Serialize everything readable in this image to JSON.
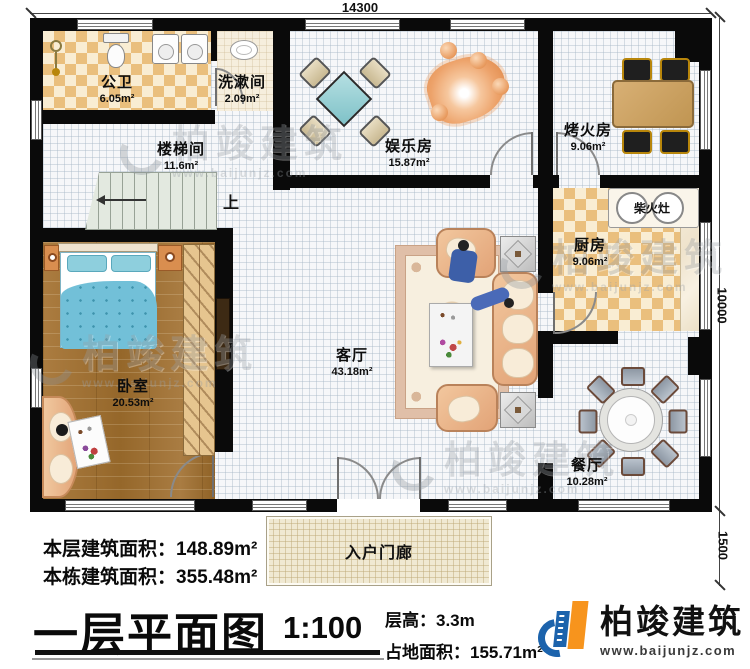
{
  "plan": {
    "dim_top": "14300",
    "dim_right": "10000",
    "dim_porch": "1500",
    "rooms": [
      {
        "name": "公卫",
        "area": "6.05m²"
      },
      {
        "name": "洗漱间",
        "area": "2.09m²"
      },
      {
        "name": "楼梯间",
        "area": "11.6m²"
      },
      {
        "name": "娱乐房",
        "area": "15.87m²"
      },
      {
        "name": "烤火房",
        "area": "9.06m²"
      },
      {
        "name": "厨房",
        "area": "9.06m²"
      },
      {
        "name": "卧室",
        "area": "20.53m²"
      },
      {
        "name": "客厅",
        "area": "43.18m²"
      },
      {
        "name": "餐厅",
        "area": "10.28m²"
      }
    ],
    "stove_label": "柴火灶",
    "stairs_up": "上",
    "porch_label": "入户门廊"
  },
  "summary": {
    "floor_label": "本层建筑面积：",
    "floor_value": "148.89m²",
    "building_label": "本栋建筑面积：",
    "building_value": "355.48m²"
  },
  "title_block": {
    "title": "一层平面图",
    "scale": "1:100",
    "height_label": "层高：",
    "height_value": "3.3m",
    "land_label": "占地面积：",
    "land_value": "155.71m²"
  },
  "brand": {
    "name": "柏竣建筑",
    "site": "www.baijunjz.com"
  },
  "watermark": {
    "name": "柏竣建筑",
    "site": "www.baijunjz.com"
  }
}
